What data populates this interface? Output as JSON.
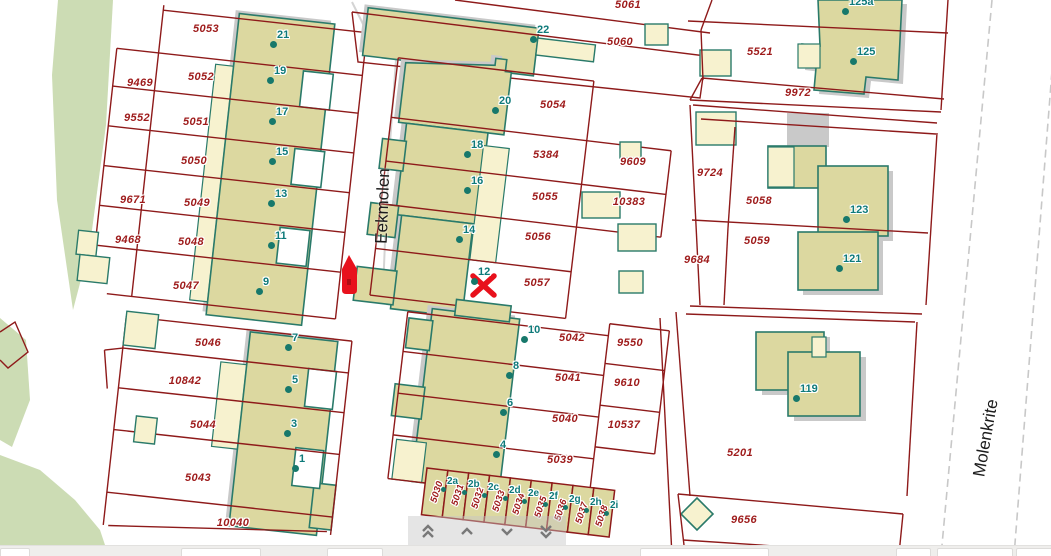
{
  "app": {
    "type": "cadastral-map-viewer"
  },
  "map": {
    "street_labels": [
      {
        "text": "Eekmolen",
        "x": 383,
        "y": 206,
        "rot": -88
      },
      {
        "text": "Molenkrite",
        "x": 986,
        "y": 438,
        "rot": -80
      }
    ],
    "parcel_labels": [
      {
        "text": "5053",
        "x": 206,
        "y": 29
      },
      {
        "text": "9469",
        "x": 140,
        "y": 83
      },
      {
        "text": "5052",
        "x": 201,
        "y": 77
      },
      {
        "text": "9552",
        "x": 137,
        "y": 118
      },
      {
        "text": "5051",
        "x": 196,
        "y": 122
      },
      {
        "text": "5050",
        "x": 194,
        "y": 161
      },
      {
        "text": "9671",
        "x": 133,
        "y": 200
      },
      {
        "text": "5049",
        "x": 197,
        "y": 203
      },
      {
        "text": "9468",
        "x": 128,
        "y": 240
      },
      {
        "text": "5048",
        "x": 191,
        "y": 242
      },
      {
        "text": "5047",
        "x": 186,
        "y": 286
      },
      {
        "text": "5046",
        "x": 208,
        "y": 343
      },
      {
        "text": "10842",
        "x": 185,
        "y": 381
      },
      {
        "text": "5044",
        "x": 203,
        "y": 425
      },
      {
        "text": "5043",
        "x": 198,
        "y": 478
      },
      {
        "text": "10040",
        "x": 233,
        "y": 523
      },
      {
        "text": "5061",
        "x": 628,
        "y": 5
      },
      {
        "text": "5060",
        "x": 620,
        "y": 42
      },
      {
        "text": "5054",
        "x": 553,
        "y": 105
      },
      {
        "text": "5384",
        "x": 546,
        "y": 155
      },
      {
        "text": "9609",
        "x": 633,
        "y": 162
      },
      {
        "text": "5055",
        "x": 545,
        "y": 197
      },
      {
        "text": "10383",
        "x": 629,
        "y": 202
      },
      {
        "text": "5056",
        "x": 538,
        "y": 237
      },
      {
        "text": "5057",
        "x": 537,
        "y": 283
      },
      {
        "text": "5042",
        "x": 572,
        "y": 338
      },
      {
        "text": "9550",
        "x": 630,
        "y": 343
      },
      {
        "text": "5041",
        "x": 568,
        "y": 378
      },
      {
        "text": "9610",
        "x": 627,
        "y": 383
      },
      {
        "text": "5040",
        "x": 565,
        "y": 419
      },
      {
        "text": "10537",
        "x": 624,
        "y": 425
      },
      {
        "text": "5039",
        "x": 560,
        "y": 460
      },
      {
        "text": "5030",
        "x": 437,
        "y": 492,
        "rot": -72,
        "small": true
      },
      {
        "text": "5031",
        "x": 458,
        "y": 495,
        "rot": -72,
        "small": true
      },
      {
        "text": "5032",
        "x": 478,
        "y": 498,
        "rot": -72,
        "small": true
      },
      {
        "text": "5033",
        "x": 499,
        "y": 501,
        "rot": -72,
        "small": true
      },
      {
        "text": "5034",
        "x": 519,
        "y": 504,
        "rot": -72,
        "small": true
      },
      {
        "text": "5035",
        "x": 541,
        "y": 507,
        "rot": -72,
        "small": true
      },
      {
        "text": "5036",
        "x": 561,
        "y": 510,
        "rot": -72,
        "small": true
      },
      {
        "text": "5037",
        "x": 582,
        "y": 513,
        "rot": -72,
        "small": true
      },
      {
        "text": "5038",
        "x": 602,
        "y": 516,
        "rot": -72,
        "small": true
      },
      {
        "text": "5521",
        "x": 760,
        "y": 52
      },
      {
        "text": "9972",
        "x": 798,
        "y": 93
      },
      {
        "text": "9724",
        "x": 710,
        "y": 173
      },
      {
        "text": "5058",
        "x": 759,
        "y": 201
      },
      {
        "text": "5059",
        "x": 757,
        "y": 241
      },
      {
        "text": "9684",
        "x": 697,
        "y": 260
      },
      {
        "text": "5201",
        "x": 740,
        "y": 453
      },
      {
        "text": "9656",
        "x": 744,
        "y": 520
      }
    ],
    "house_numbers": [
      {
        "t": "21",
        "x": 273,
        "y": 44
      },
      {
        "t": "19",
        "x": 270,
        "y": 80
      },
      {
        "t": "17",
        "x": 272,
        "y": 121
      },
      {
        "t": "15",
        "x": 272,
        "y": 161
      },
      {
        "t": "13",
        "x": 271,
        "y": 203
      },
      {
        "t": "11",
        "x": 271,
        "y": 245
      },
      {
        "t": "9",
        "x": 259,
        "y": 291
      },
      {
        "t": "7",
        "x": 288,
        "y": 347
      },
      {
        "t": "5",
        "x": 288,
        "y": 389
      },
      {
        "t": "3",
        "x": 287,
        "y": 433
      },
      {
        "t": "1",
        "x": 295,
        "y": 468
      },
      {
        "t": "22",
        "x": 533,
        "y": 39
      },
      {
        "t": "20",
        "x": 495,
        "y": 110
      },
      {
        "t": "18",
        "x": 467,
        "y": 154
      },
      {
        "t": "16",
        "x": 467,
        "y": 190
      },
      {
        "t": "14",
        "x": 459,
        "y": 239
      },
      {
        "t": "12",
        "x": 474,
        "y": 281
      },
      {
        "t": "10",
        "x": 524,
        "y": 339
      },
      {
        "t": "8",
        "x": 509,
        "y": 375
      },
      {
        "t": "6",
        "x": 503,
        "y": 412
      },
      {
        "t": "4",
        "x": 496,
        "y": 454
      },
      {
        "t": "2a",
        "x": 443,
        "y": 489,
        "s": true
      },
      {
        "t": "2b",
        "x": 464,
        "y": 492,
        "s": true
      },
      {
        "t": "2c",
        "x": 484,
        "y": 495,
        "s": true
      },
      {
        "t": "2d",
        "x": 505,
        "y": 498,
        "s": true
      },
      {
        "t": "2e",
        "x": 524,
        "y": 501,
        "s": true
      },
      {
        "t": "2f",
        "x": 545,
        "y": 504,
        "s": true
      },
      {
        "t": "2g",
        "x": 565,
        "y": 507,
        "s": true
      },
      {
        "t": "2h",
        "x": 586,
        "y": 510,
        "s": true
      },
      {
        "t": "2i",
        "x": 606,
        "y": 513,
        "s": true
      },
      {
        "t": "125a",
        "x": 845,
        "y": 11
      },
      {
        "t": "125",
        "x": 853,
        "y": 61
      },
      {
        "t": "123",
        "x": 846,
        "y": 219
      },
      {
        "t": "121",
        "x": 839,
        "y": 268
      },
      {
        "t": "119",
        "x": 796,
        "y": 398
      }
    ],
    "markers": [
      {
        "type": "x-marker",
        "x": 483,
        "y": 285
      },
      {
        "type": "hydrant-marker",
        "x": 349,
        "y": 275
      }
    ],
    "colors": {
      "parcel_line": "#8e1a1a",
      "building_fill": "#dcd8a0",
      "building_outline": "#2a7a6a",
      "annex_fill": "#f7f2cf",
      "shadow": "#c9c9c9",
      "green_area": "#ccdcb4",
      "parcel_label": "#9e1b1b",
      "house_label": "#0e7a7a",
      "marker_red": "#e8111c",
      "road_dash": "#c8c8c8"
    }
  },
  "nav": {
    "buttons": [
      {
        "name": "scroll-up-fast",
        "icon": "chevron-double-up"
      },
      {
        "name": "scroll-up",
        "icon": "chevron-up"
      },
      {
        "name": "scroll-down",
        "icon": "chevron-down"
      },
      {
        "name": "scroll-down-fast",
        "icon": "chevron-double-down"
      }
    ]
  },
  "bottom_bar": {
    "boxes": [
      {
        "x": 0,
        "w": 28
      },
      {
        "x": 181,
        "w": 78
      },
      {
        "x": 327,
        "w": 54
      },
      {
        "x": 640,
        "w": 127
      },
      {
        "x": 896,
        "w": 33
      },
      {
        "x": 937,
        "w": 74
      },
      {
        "x": 1016,
        "w": 35
      }
    ]
  }
}
